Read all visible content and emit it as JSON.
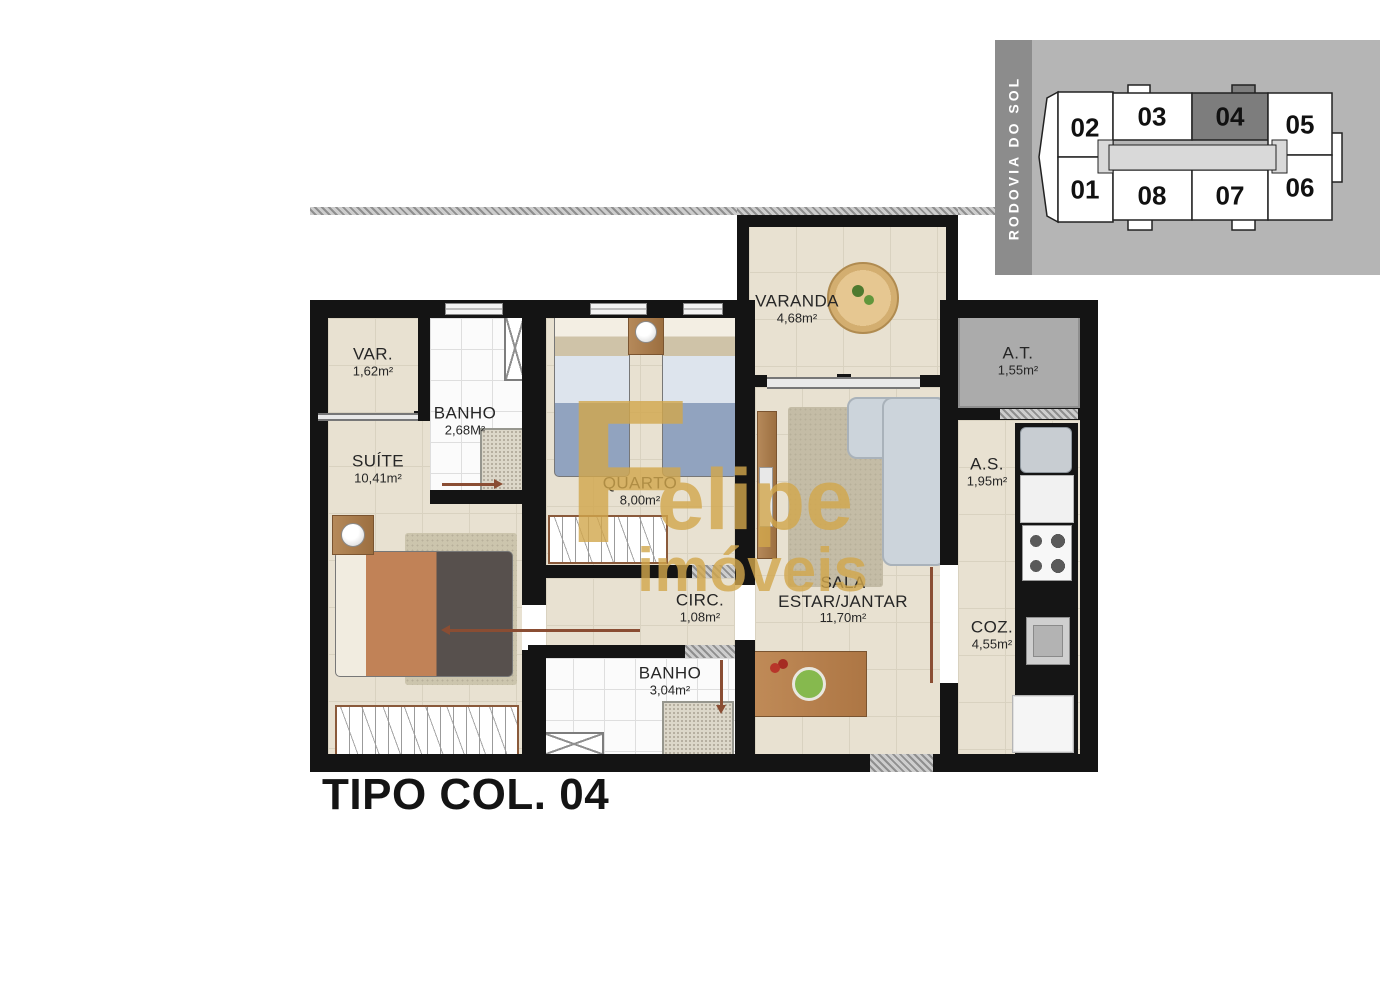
{
  "title": "TIPO COL. 04",
  "watermark": {
    "initial": "F",
    "name": "elipe",
    "suffix": "imóveis"
  },
  "keyplan": {
    "road": "RODOVIA DO SOL",
    "highlighted": "04",
    "units": [
      "02",
      "03",
      "04",
      "05",
      "01",
      "08",
      "07",
      "06"
    ],
    "colors": {
      "panel": "#b5b5b5",
      "bar": "#8c8c8c",
      "highlight": "#7d7d7d",
      "corridor": "#d9d9d9"
    }
  },
  "rooms": {
    "var": {
      "name": "VAR.",
      "area": "1,62m²"
    },
    "banho_suite": {
      "name": "BANHO",
      "area": "2,68M²"
    },
    "quarto": {
      "name": "QUARTO",
      "area": "8,00m²"
    },
    "varanda": {
      "name": "VARANDA",
      "area": "4,68m²"
    },
    "at": {
      "name": "A.T.",
      "area": "1,55m²"
    },
    "suite": {
      "name": "SUÍTE",
      "area": "10,41m²"
    },
    "as": {
      "name": "A.S.",
      "area": "1,95m²"
    },
    "circ": {
      "name": "CIRC.",
      "area": "1,08m²"
    },
    "sala": {
      "name1": "SALA",
      "name2": "ESTAR/JANTAR",
      "area": "11,70m²"
    },
    "banho_social": {
      "name": "BANHO",
      "area": "3,04m²"
    },
    "coz": {
      "name": "COZ.",
      "area": "4,55m²"
    }
  },
  "colors": {
    "floor": "#e8e1d1",
    "wall": "#141414",
    "watermark_gold": "#d2a74c"
  }
}
